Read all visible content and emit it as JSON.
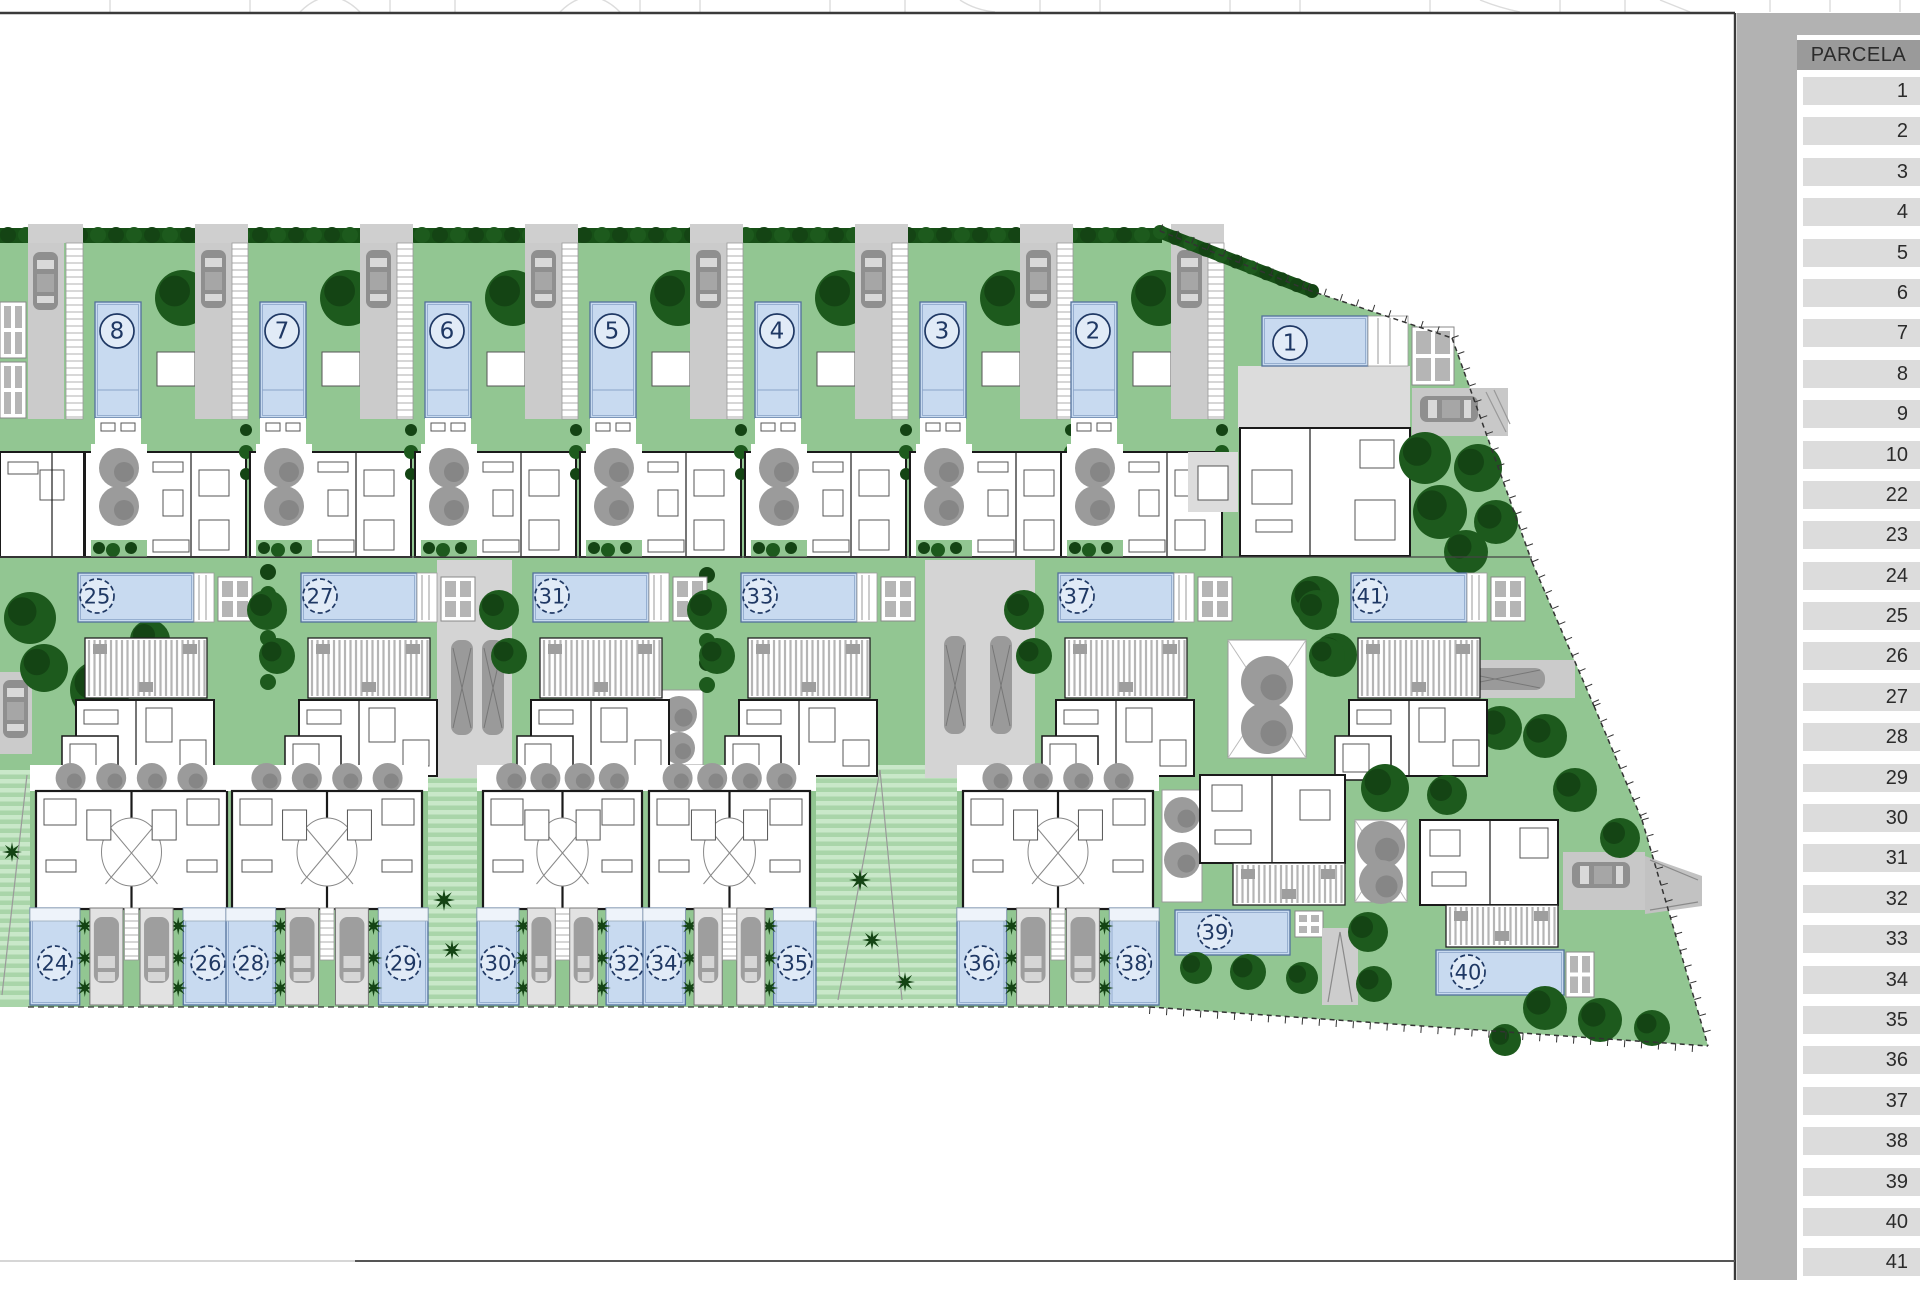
{
  "sidebar": {
    "header": "PARCELA",
    "parcels": [
      "1",
      "2",
      "3",
      "4",
      "5",
      "6",
      "7",
      "8",
      "9",
      "10",
      "22",
      "23",
      "24",
      "25",
      "26",
      "27",
      "28",
      "29",
      "30",
      "31",
      "32",
      "33",
      "34",
      "35",
      "36",
      "37",
      "38",
      "39",
      "40",
      "41"
    ]
  },
  "site_plan": {
    "top_row": [
      {
        "num": "8",
        "x": 83
      },
      {
        "num": "7",
        "x": 248
      },
      {
        "num": "6",
        "x": 413
      },
      {
        "num": "5",
        "x": 578
      },
      {
        "num": "4",
        "x": 743
      },
      {
        "num": "3",
        "x": 908
      },
      {
        "num": "2",
        "x": 1059
      }
    ],
    "parcel_1": {
      "num": "1",
      "cx": 1290,
      "cy": 343
    },
    "middle_row": [
      {
        "num": "25",
        "x": 60
      },
      {
        "num": "27",
        "x": 283
      },
      {
        "num": "31",
        "x": 515
      },
      {
        "num": "33",
        "x": 723
      },
      {
        "num": "37",
        "x": 1040
      },
      {
        "num": "41",
        "x": 1333
      }
    ],
    "bottom_blocks": [
      {
        "nums": [
          "24",
          "26"
        ],
        "x": 30,
        "w": 203
      },
      {
        "nums": [
          "28",
          "29"
        ],
        "x": 226,
        "w": 202
      },
      {
        "nums": [
          "30",
          "32"
        ],
        "x": 477,
        "w": 171
      },
      {
        "nums": [
          "34",
          "35"
        ],
        "x": 643,
        "w": 173
      },
      {
        "nums": [
          "36",
          "38"
        ],
        "x": 957,
        "w": 202
      }
    ],
    "villa_39": {
      "num": "39",
      "cx": 1215,
      "cy": 932
    },
    "villa_40": {
      "num": "40",
      "cx": 1468,
      "cy": 972
    }
  },
  "colors": {
    "lawn": "#92c692",
    "stripeA": "#a9d5a9",
    "stripeB": "#c9e8c9",
    "hedge": "#175017",
    "tree": "#1d5a1d",
    "treeDark": "#144414",
    "grayTree": "#9b9b9b",
    "grayTreeDark": "#868686",
    "pool": "#c8daf0",
    "poolEdge": "#53719c",
    "poolLine": "#8aa4c8",
    "pave": "#cbcbcb",
    "paveLight": "#e2e2e2",
    "car": "#8f8f8f",
    "carLight": "#d9d9d9",
    "houseLine": "#1a1a1a",
    "furn": "#555555",
    "navy": "#1f3864",
    "frame": "#3a3a3a",
    "boundary": "#333333",
    "terrace": "#dcdcdc",
    "sidebarBg": "#b2b2b2",
    "headerBg": "#9a9a9a",
    "cellBg": "#dcdcdc",
    "textDark": "#2b2b2b",
    "watermark": "#dcdcdc"
  }
}
